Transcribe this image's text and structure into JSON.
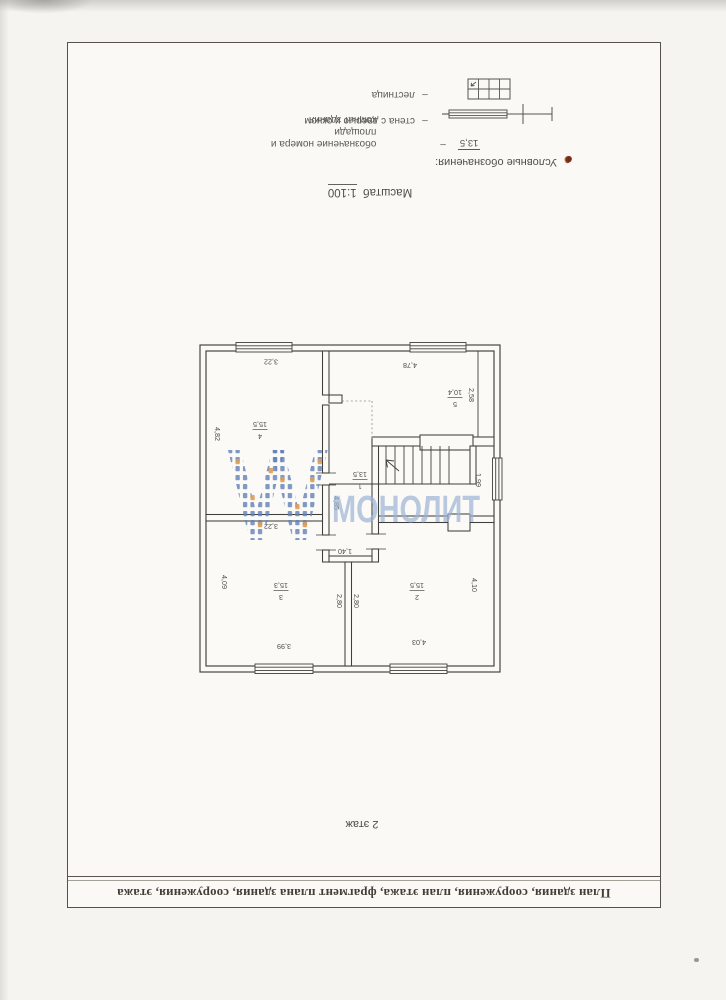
{
  "page": {
    "title_block": "План здания, сооружения, план этажа, фрагмент плана здания, сооружения, этажа",
    "floor_label": "2 этаж",
    "scale_prefix": "Масштаб",
    "scale_value": "1:100",
    "legend_title": "Условные обозначения:",
    "legend_dash": "–",
    "legend": {
      "items": [
        {
          "symbol": "13,5",
          "line1": "обозначение номера и площади",
          "line2": "комнат здания"
        },
        {
          "line1": "стена с дверью и окном"
        },
        {
          "line1": "лестница"
        }
      ]
    },
    "watermark_text": "МОНОЛИТ"
  },
  "plan": {
    "rooms": {
      "r1": {
        "number": "1",
        "area": "13,5"
      },
      "r2": {
        "number": "2",
        "area": "15,5"
      },
      "r3": {
        "number": "3",
        "area": "15,3"
      },
      "r4": {
        "number": "4",
        "area": "15,5"
      },
      "r5": {
        "number": "5",
        "area": "10,4"
      }
    },
    "dims": {
      "r4_top": "3,22",
      "r5_top": "4,78",
      "r5_right": "2,58",
      "r4_left": "4,82",
      "hall_left": "4,85",
      "stair_window": "1,99",
      "r3_top": "3,22",
      "corridor": "1,40",
      "center_left": "2,80",
      "center_right": "2,80",
      "r3_left": "4,09",
      "r2_right": "4,10",
      "r3_bottom": "3,99",
      "r2_bottom": "4,03"
    }
  },
  "colors": {
    "plan_line": "#3f3f3b",
    "frame_line": "#55524c",
    "watermark_text_blue": "#9db3d6",
    "watermark_dot_blue": "#6080b8",
    "watermark_dot_orange": "#df9d58",
    "legend_mark_red": "#7c2a18"
  }
}
